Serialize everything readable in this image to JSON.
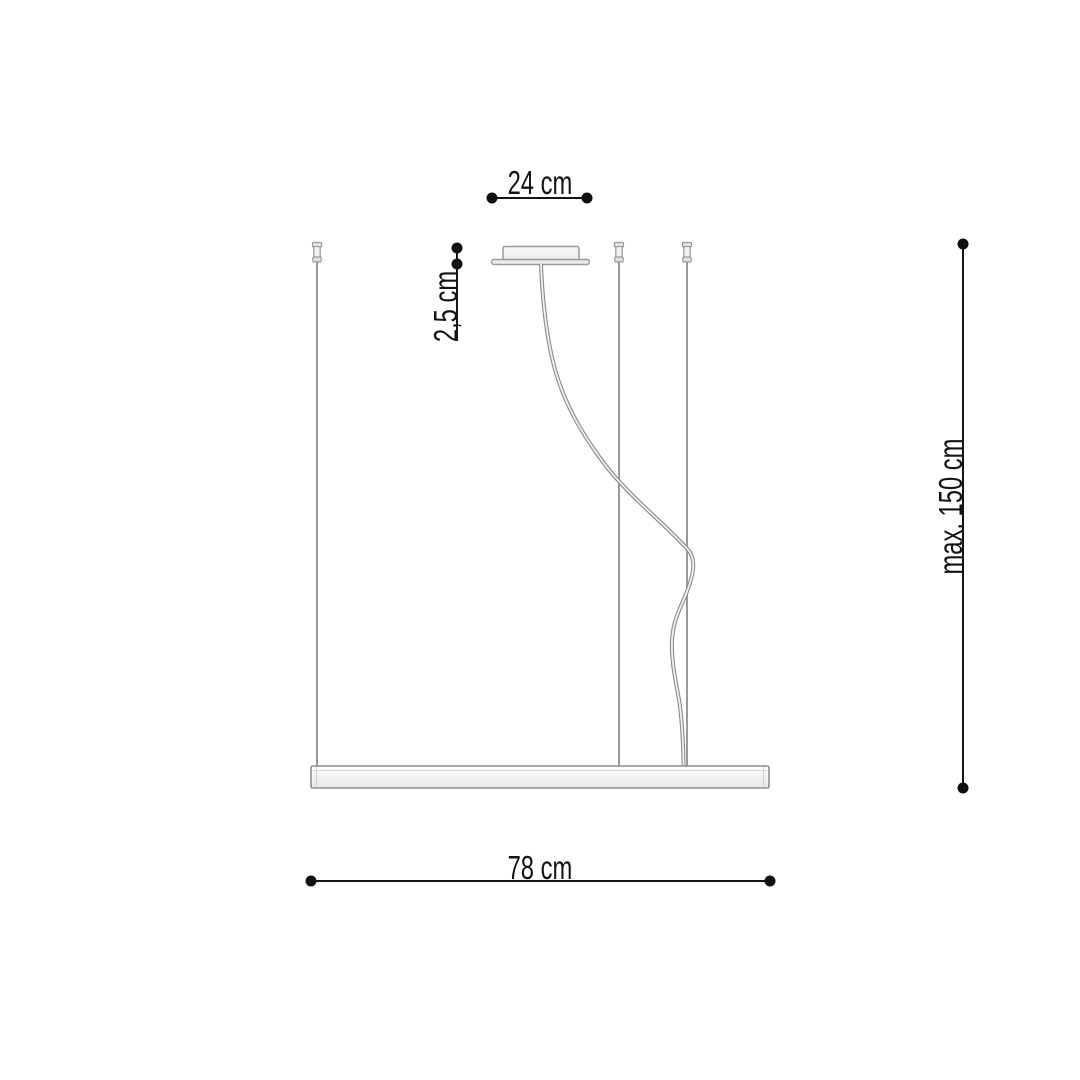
{
  "labels": {
    "canopy_width": "24 cm",
    "canopy_height": "2,5 cm",
    "suspension_max_height": "max. 150 cm",
    "fixture_width": "78 cm"
  },
  "colors": {
    "dimension_ink": "#141414",
    "fixture_outline": "#9a9a9a",
    "background": "#ffffff"
  }
}
